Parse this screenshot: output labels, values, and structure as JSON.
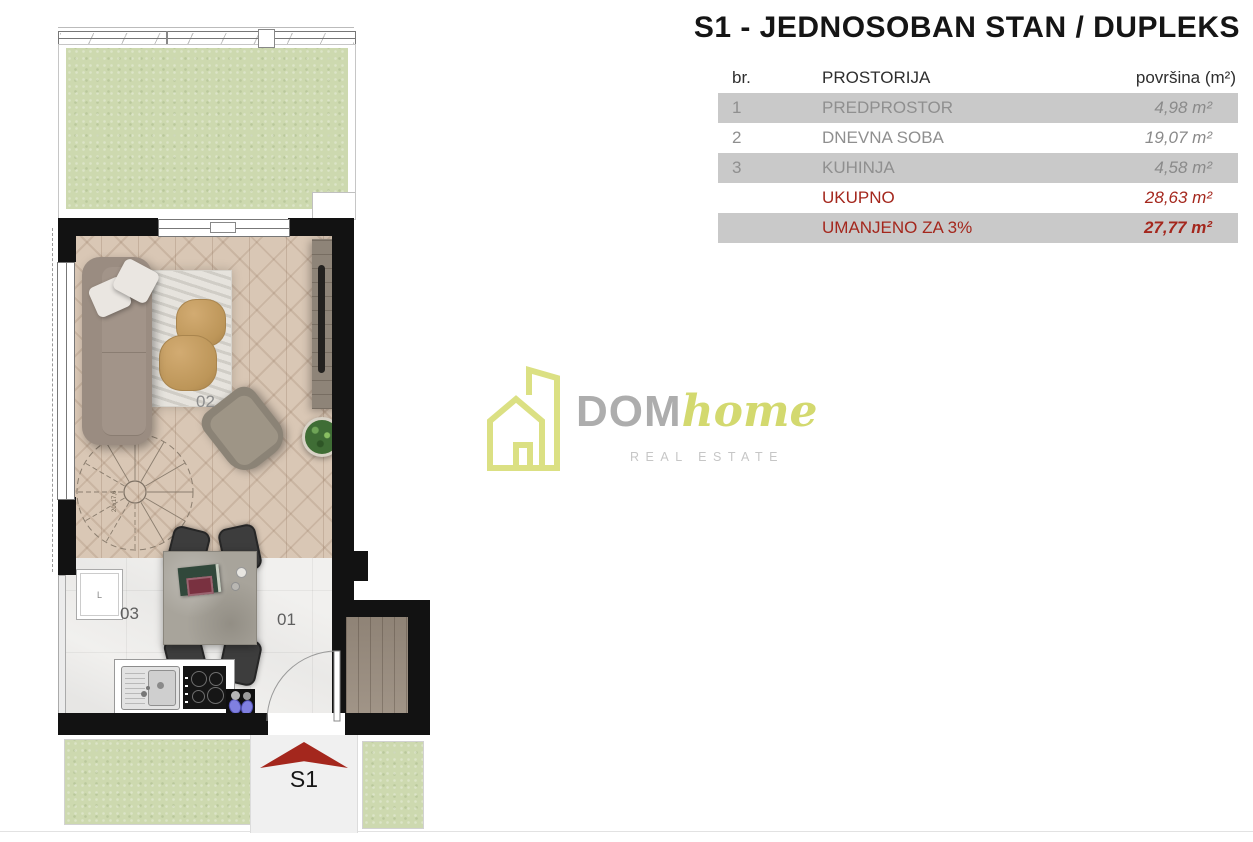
{
  "title": "S1 - JEDNOSOBAN STAN / DUPLEKS",
  "table": {
    "headers": {
      "num": "br.",
      "room": "PROSTORIJA",
      "area": "površina (m²)"
    },
    "rows": [
      {
        "num": "1",
        "room": "PREDPROSTOR",
        "area": "4,98 m²"
      },
      {
        "num": "2",
        "room": "DNEVNA SOBA",
        "area": "19,07 m²"
      },
      {
        "num": "3",
        "room": "KUHINJA",
        "area": "4,58 m²"
      }
    ],
    "total": {
      "label": "UKUPNO",
      "area": "28,63 m²"
    },
    "reduced": {
      "label": "UMANJENO ZA 3%",
      "area": "27,77 m²"
    }
  },
  "logo": {
    "name": "DOM",
    "name2": "home",
    "subtitle": "REAL ESTATE"
  },
  "plan": {
    "unit_label": "S1",
    "labels": {
      "hall": "01",
      "living": "02",
      "kitchen": "03"
    },
    "stair_annotation": "20x17,6",
    "appliance_label": "L"
  },
  "colors": {
    "accent_red": "#a4271d",
    "logo_green": "#dbe083",
    "grass": "#cdd9af",
    "row_gray": "#c9c9c9",
    "wall": "#121212"
  }
}
